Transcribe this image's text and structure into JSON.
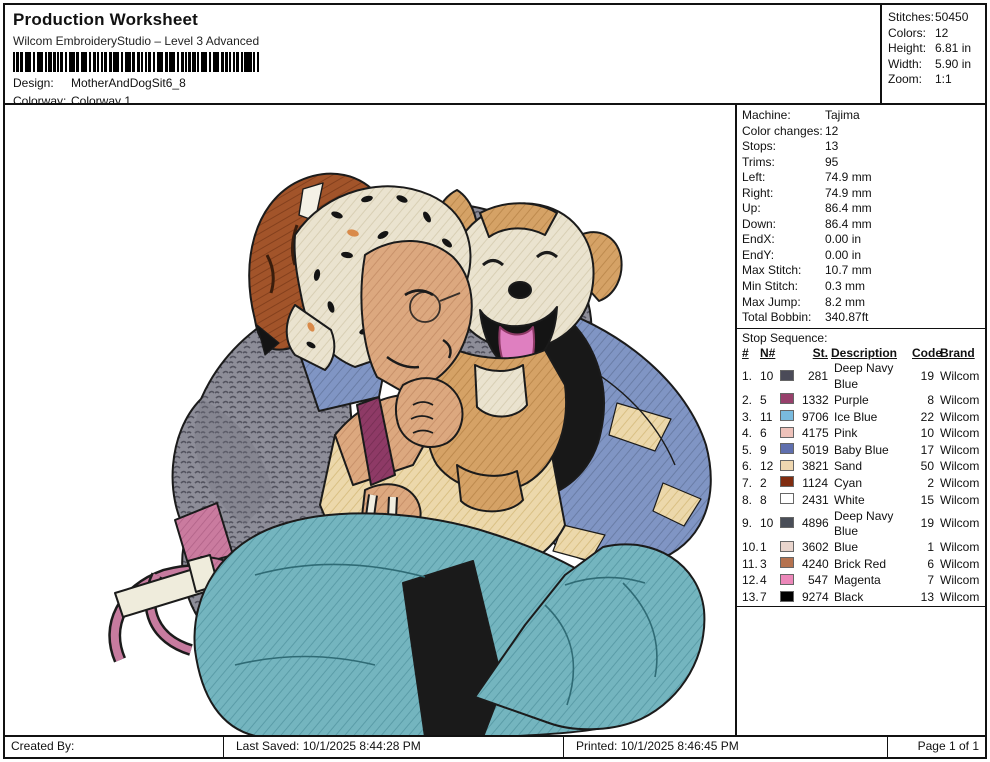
{
  "header": {
    "title": "Production Worksheet",
    "subtitle": "Wilcom EmbroideryStudio – Level 3 Advanced",
    "design_label": "Design:",
    "design_value": "MotherAndDogSit6_8",
    "colorway_label": "Colorway:",
    "colorway_value": "Colorway 1"
  },
  "stats": [
    {
      "label": "Stitches:",
      "value": "50450"
    },
    {
      "label": "Colors:",
      "value": "12"
    },
    {
      "label": "Height:",
      "value": "6.81 in"
    },
    {
      "label": "Width:",
      "value": "5.90 in"
    },
    {
      "label": "Zoom:",
      "value": "1:1"
    }
  ],
  "machine_info": [
    {
      "label": "Machine:",
      "value": "Tajima"
    },
    {
      "label": "Color changes:",
      "value": "12"
    },
    {
      "label": "Stops:",
      "value": "13"
    },
    {
      "label": "Trims:",
      "value": "95"
    },
    {
      "label": "Left:",
      "value": "74.9 mm"
    },
    {
      "label": "Right:",
      "value": "74.9 mm"
    },
    {
      "label": "Up:",
      "value": "86.4 mm"
    },
    {
      "label": "Down:",
      "value": "86.4 mm"
    },
    {
      "label": "EndX:",
      "value": "0.00 in"
    },
    {
      "label": "EndY:",
      "value": "0.00 in"
    },
    {
      "label": "Max Stitch:",
      "value": "10.7 mm"
    },
    {
      "label": "Min Stitch:",
      "value": "0.3 mm"
    },
    {
      "label": "Max Jump:",
      "value": "8.2 mm"
    },
    {
      "label": "Total Bobbin:",
      "value": "340.87ft"
    }
  ],
  "stop_sequence": {
    "title": "Stop Sequence:",
    "columns": [
      "#",
      "N#",
      "St.",
      "Description",
      "Code",
      "Brand"
    ],
    "rows": [
      {
        "num": "1.",
        "n": "10",
        "color": "#4b4b58",
        "st": "281",
        "description": "Deep Navy Blue",
        "code": "19",
        "brand": "Wilcom"
      },
      {
        "num": "2.",
        "n": "5",
        "color": "#97406b",
        "st": "1332",
        "description": "Purple",
        "code": "8",
        "brand": "Wilcom"
      },
      {
        "num": "3.",
        "n": "11",
        "color": "#79bade",
        "st": "9706",
        "description": "Ice Blue",
        "code": "22",
        "brand": "Wilcom"
      },
      {
        "num": "4.",
        "n": "6",
        "color": "#eec2ba",
        "st": "4175",
        "description": "Pink",
        "code": "10",
        "brand": "Wilcom"
      },
      {
        "num": "5.",
        "n": "9",
        "color": "#5f6fae",
        "st": "5019",
        "description": "Baby Blue",
        "code": "17",
        "brand": "Wilcom"
      },
      {
        "num": "6.",
        "n": "12",
        "color": "#efd7b0",
        "st": "3821",
        "description": "Sand",
        "code": "50",
        "brand": "Wilcom"
      },
      {
        "num": "7.",
        "n": "2",
        "color": "#802c10",
        "st": "1124",
        "description": "Cyan",
        "code": "2",
        "brand": "Wilcom"
      },
      {
        "num": "8.",
        "n": "8",
        "color": "#ffffff",
        "st": "2431",
        "description": "White",
        "code": "15",
        "brand": "Wilcom"
      },
      {
        "num": "9.",
        "n": "10",
        "color": "#4a4e58",
        "st": "4896",
        "description": "Deep Navy Blue",
        "code": "19",
        "brand": "Wilcom"
      },
      {
        "num": "10.",
        "n": "1",
        "color": "#e9d5cd",
        "st": "3602",
        "description": "Blue",
        "code": "1",
        "brand": "Wilcom"
      },
      {
        "num": "11.",
        "n": "3",
        "color": "#b5724f",
        "st": "4240",
        "description": "Brick Red",
        "code": "6",
        "brand": "Wilcom"
      },
      {
        "num": "12.",
        "n": "4",
        "color": "#ec87b9",
        "st": "547",
        "description": "Magenta",
        "code": "7",
        "brand": "Wilcom"
      },
      {
        "num": "13.",
        "n": "7",
        "color": "#000000",
        "st": "9274",
        "description": "Black",
        "code": "13",
        "brand": "Wilcom"
      }
    ]
  },
  "footer": {
    "created_by": "Created By:",
    "last_saved": "Last Saved: 10/1/2025 8:44:28 PM",
    "printed": "Printed: 10/1/2025 8:46:45 PM",
    "page": "Page 1 of 1"
  }
}
